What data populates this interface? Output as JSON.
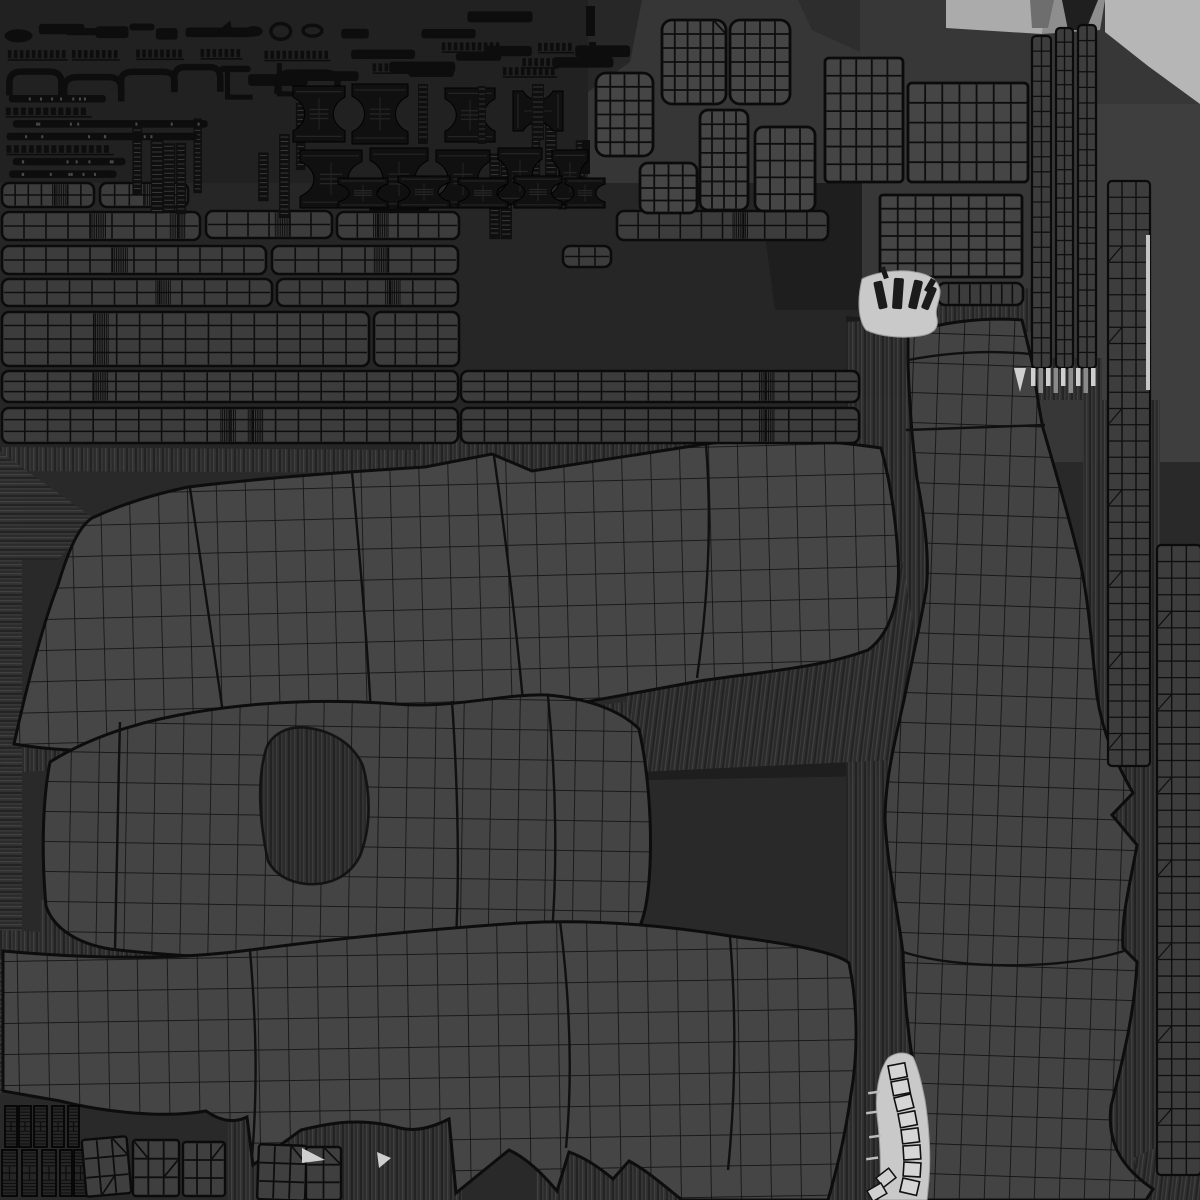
{
  "canvas": {
    "w": 1200,
    "h": 1200,
    "bg": "#292929"
  },
  "palette": {
    "base": "#292929",
    "dark_zone": "#212121",
    "mid_zone": "#363636",
    "right_zone": "#373737",
    "light_band": "#ababab",
    "light_corner": "#b6b6b6",
    "mesh_fill": "#454545",
    "strip_fill": "#3c3c3c",
    "wire": "#0d0d0d",
    "hardware": "#0f0f0f",
    "zipper_light": "#c9c9c9",
    "tooth_light": "#cfcfcf"
  },
  "patterns": {
    "grids": [
      {
        "id": "gA",
        "cw": 29,
        "ch": 31,
        "bg": "#464646",
        "line": "#141414",
        "lw": 1.7,
        "rot": -1.5
      },
      {
        "id": "gB",
        "cw": 28,
        "ch": 30,
        "bg": "#444444",
        "line": "#141414",
        "lw": 1.7,
        "rot": 1
      },
      {
        "id": "gC",
        "cw": 30,
        "ch": 31,
        "bg": "#454545",
        "line": "#131313",
        "lw": 1.7,
        "rot": -1
      },
      {
        "id": "gD",
        "cw": 25,
        "ch": 30,
        "bg": "#434343",
        "line": "#121212",
        "lw": 1.7,
        "rot": 2
      }
    ],
    "streaks": [
      {
        "id": "p-sv",
        "rot": 0
      },
      {
        "id": "p-sh",
        "rot": 90
      },
      {
        "id": "p-sd",
        "rot": 7
      }
    ],
    "streak_stripes": [
      [
        "#232323",
        2
      ],
      [
        "#3e3e3e",
        1
      ],
      [
        "#2b2b2b",
        2
      ],
      [
        "#464646",
        1
      ],
      [
        "#303030",
        3
      ]
    ]
  },
  "bg_patches": [
    {
      "pts": "0,0 588,0 588,183 0,183",
      "f": "#212121"
    },
    {
      "pts": "560,183 650,183 672,215 560,215",
      "f": "#212121"
    },
    {
      "pts": "588,0 860,0 860,215 672,215 650,183 588,183",
      "f": "#363636"
    },
    {
      "pts": "588,0 642,0 630,62 588,92",
      "f": "#272727"
    },
    {
      "pts": "798,0 860,0 860,52 812,30",
      "f": "#2d2d2d"
    },
    {
      "pts": "860,0 1200,0 1200,462 860,462",
      "f": "#373737"
    },
    {
      "pts": "946,0 1048,0 1042,34 946,28",
      "f": "#ababab"
    },
    {
      "pts": "1048,0 1105,0 1100,30 1042,34",
      "f": "#8e8e8e"
    },
    {
      "pts": "1105,0 1200,0 1200,104 1148,66 1105,32",
      "f": "#b6b6b6"
    },
    {
      "pts": "1062,0 1098,0 1086,30 1068,30",
      "f": "#1f1f1f"
    },
    {
      "pts": "1030,0 1054,0 1048,28 1032,28",
      "f": "#6e6e6e"
    },
    {
      "pts": "1096,104 1200,104 1200,462 1096,462",
      "f": "#3e3e3e"
    },
    {
      "pts": "0,183 862,183 862,452 0,452",
      "f": "#262626"
    },
    {
      "pts": "758,183 862,183 862,310 775,310",
      "f": "#1e1e1e"
    },
    {
      "pts": "846,316 912,322 938,460 846,560",
      "f": "#1a1a1a"
    },
    {
      "pts": "862,398 944,398 944,460 868,452",
      "f": "#2e2e2e"
    },
    {
      "pts": "640,690 940,642 940,775 648,780",
      "f": "#1e1e1e"
    },
    {
      "pts": "845,1040 942,1040 942,1200 845,1200",
      "f": "#1d1d1d"
    }
  ],
  "fringes": [
    {
      "pts": "0,447 420,450 420,473 0,471",
      "p": "p-sv"
    },
    {
      "pts": "420,432 893,440 893,463 420,473",
      "p": "p-sv"
    },
    {
      "pts": "0,452 95,519 58,560 0,560",
      "p": "p-sh"
    },
    {
      "pts": "0,742 520,716 640,700 640,731 520,748 0,773",
      "p": "p-sv"
    },
    {
      "pts": "40,900 640,928 640,963 40,963",
      "p": "p-sv"
    },
    {
      "pts": "0,468 22,468 22,1095 0,1095",
      "p": "p-sh"
    },
    {
      "pts": "846,322 944,316 944,1200 846,1200",
      "p": "p-sv"
    },
    {
      "pts": "1083,400 1160,400 1160,1195 1083,1195",
      "p": "p-sv"
    },
    {
      "pts": "600,560 900,548 936,758 640,772",
      "p": "p-sd"
    },
    {
      "pts": "228,1093 462,1120 462,1200 228,1200",
      "p": "p-sv"
    },
    {
      "pts": "536,1128 862,1120 862,1200 536,1200",
      "p": "p-sv"
    },
    {
      "pts": "878,458 942,452 942,562 892,562",
      "p": "p-sv"
    },
    {
      "pts": "1133,1158 1200,1128 1200,1200 1148,1200",
      "p": "p-sd"
    },
    {
      "pts": "898,296 1032,288 1032,332 898,340",
      "p": "p-sv"
    },
    {
      "pts": "1028,358 1102,358 1102,400 1028,400",
      "p": "p-sv"
    },
    {
      "pts": "0,930 242,941 242,966 0,958",
      "p": "p-sv"
    },
    {
      "pts": "240,660 470,648 470,700 240,712",
      "p": "p-sd"
    }
  ],
  "islands": [
    {
      "name": "uv-island-top-panel",
      "grid": "gA",
      "path": "M14,744 C28,680 45,618 58,585 C70,545 80,526 92,518 C120,505 155,494 188,487 C270,477 360,471 425,467 L492,454 L532,471 C580,464 642,454 705,444 C770,435 832,441 881,448 C890,480 896,520 898,557 C901,600 890,634 868,650 C820,668 760,672 700,681 C640,692 575,704 520,714 C420,728 310,740 215,748 C140,754 58,752 14,744 Z",
      "seams": [
        "M190,488 C203,575 216,662 228,747",
        "M494,456 C506,540 516,625 524,712",
        "M706,445 C712,520 708,600 697,678",
        "M352,472 C360,560 368,650 372,733"
      ]
    },
    {
      "name": "uv-island-collar-panel",
      "grid": "gB",
      "path": "M46,906 C41,850 43,798 50,762 C90,737 140,721 196,712 C262,701 332,699 396,704 C452,709 506,693 548,695 C592,699 622,712 639,729 C648,770 652,820 650,866 C648,906 642,928 634,933 C560,948 468,958 378,960 C288,962 178,957 110,949 C80,944 54,930 46,906 Z",
      "hole": "M268,861 C259,820 257,779 266,749 C272,733 289,725 309,728 C331,731 353,743 363,766 C371,795 371,828 360,856 C350,876 330,886 306,884 C287,882 274,873 268,861 Z",
      "seams": [
        "M452,701 C458,790 460,878 455,958",
        "M548,696 C556,780 558,868 551,945",
        "M120,722 C118,800 116,880 115,950"
      ]
    },
    {
      "name": "uv-island-bottom-panel",
      "grid": "gC",
      "path": "M3,951 C80,958 168,961 250,950 C340,938 432,929 520,923 C592,919 662,925 730,936 C790,944 836,952 849,963 C857,1002 859,1048 851,1094 C845,1138 836,1172 828,1200 L682,1200 C662,1184 646,1170 629,1161 L613,1179 C600,1168 586,1158 569,1152 L557,1191 C541,1172 526,1158 509,1150 L456,1193 L449,1119 C431,1128 415,1132 400,1128 C360,1117 330,1123 301,1130 L253,1165 L247,1117 C231,1125 216,1118 206,1111 C160,1119 100,1111 60,1101 L3,1091 Z",
      "seams": [
        "M250,951 C256,1020 258,1085 252,1158",
        "M560,921 C570,1000 573,1075 566,1148",
        "M730,937 C736,1010 736,1090 728,1170"
      ]
    },
    {
      "name": "uv-island-leg-panel",
      "grid": "gD",
      "path": "M908,334 C940,322 984,317 1022,320 L1033,366 C1037,396 1040,414 1043,428 C1055,470 1070,520 1081,566 C1090,610 1092,652 1097,696 C1103,736 1118,766 1133,793 L1112,815 L1137,845 C1130,885 1121,916 1123,948 L1137,962 C1135,1010 1123,1060 1111,1106 C1107,1140 1119,1166 1153,1189 L1146,1200 L921,1200 C928,1155 922,1110 913,1063 C906,1020 904,986 903,953 C897,906 887,863 885,820 C885,780 895,740 904,700 C912,660 920,626 926,591 C930,560 925,520 917,479 C912,440 909,400 908,360 Z",
      "seams": [
        "M906,430 L1045,425",
        "M903,952 C960,970 1062,970 1124,951",
        "M908,360 C950,352 990,350 1030,354"
      ]
    }
  ],
  "strips": [
    {
      "x": 2,
      "y": 183,
      "w": 92,
      "h": 24,
      "rows": 2,
      "cols": 7,
      "dense": [
        0.55
      ]
    },
    {
      "x": 100,
      "y": 183,
      "w": 88,
      "h": 24,
      "rows": 2,
      "cols": 6,
      "dense": [
        0.5
      ]
    },
    {
      "x": 2,
      "y": 212,
      "w": 198,
      "h": 28,
      "rows": 2,
      "cols": 9,
      "dense": [
        0.45,
        0.85
      ]
    },
    {
      "x": 206,
      "y": 211,
      "w": 126,
      "h": 27,
      "rows": 2,
      "cols": 6,
      "dense": [
        0.55
      ]
    },
    {
      "x": 337,
      "y": 212,
      "w": 122,
      "h": 27,
      "rows": 2,
      "cols": 6,
      "dense": [
        0.3
      ]
    },
    {
      "x": 617,
      "y": 211,
      "w": 211,
      "h": 29,
      "rows": 2,
      "cols": 10,
      "dense": [
        0.55
      ]
    },
    {
      "x": 2,
      "y": 246,
      "w": 264,
      "h": 28,
      "rows": 2,
      "cols": 12,
      "dense": [
        0.42
      ]
    },
    {
      "x": 272,
      "y": 246,
      "w": 186,
      "h": 28,
      "rows": 2,
      "cols": 8,
      "dense": [
        0.55
      ]
    },
    {
      "x": 563,
      "y": 246,
      "w": 48,
      "h": 21,
      "rows": 2,
      "cols": 3,
      "dense": []
    },
    {
      "x": 2,
      "y": 279,
      "w": 270,
      "h": 27,
      "rows": 2,
      "cols": 12,
      "dense": [
        0.57
      ]
    },
    {
      "x": 277,
      "y": 279,
      "w": 181,
      "h": 27,
      "rows": 2,
      "cols": 8,
      "dense": [
        0.6
      ]
    },
    {
      "x": 2,
      "y": 312,
      "w": 367,
      "h": 54,
      "rows": 4,
      "cols": 16,
      "dense": [
        0.25
      ]
    },
    {
      "x": 374,
      "y": 312,
      "w": 85,
      "h": 54,
      "rows": 4,
      "cols": 4,
      "dense": []
    },
    {
      "x": 2,
      "y": 371,
      "w": 456,
      "h": 31,
      "rows": 3,
      "cols": 20,
      "dense": [
        0.2
      ]
    },
    {
      "x": 461,
      "y": 371,
      "w": 398,
      "h": 31,
      "rows": 3,
      "cols": 17,
      "dense": [
        0.75
      ]
    },
    {
      "x": 2,
      "y": 408,
      "w": 456,
      "h": 35,
      "rows": 3,
      "cols": 20,
      "dense": [
        0.48,
        0.54
      ]
    },
    {
      "x": 461,
      "y": 408,
      "w": 398,
      "h": 35,
      "rows": 3,
      "cols": 17,
      "dense": [
        0.75
      ]
    },
    {
      "x": 938,
      "y": 283,
      "w": 85,
      "h": 22,
      "rows": 1,
      "cols": 8,
      "dense": []
    }
  ],
  "blocks": [
    {
      "x": 662,
      "y": 20,
      "w": 64,
      "h": 84,
      "cols": 5,
      "rows": 6,
      "rx": 10,
      "diag": [
        [
          4,
          0,
          1
        ]
      ]
    },
    {
      "x": 730,
      "y": 20,
      "w": 60,
      "h": 84,
      "cols": 4,
      "rows": 6,
      "rx": 10,
      "diag": []
    },
    {
      "x": 596,
      "y": 73,
      "w": 57,
      "h": 83,
      "cols": 4,
      "rows": 6,
      "rx": 10,
      "diag": []
    },
    {
      "x": 700,
      "y": 110,
      "w": 48,
      "h": 100,
      "cols": 4,
      "rows": 7,
      "rx": 8,
      "diag": []
    },
    {
      "x": 755,
      "y": 127,
      "w": 60,
      "h": 84,
      "cols": 4,
      "rows": 5,
      "rx": 8,
      "diag": []
    },
    {
      "x": 640,
      "y": 163,
      "w": 57,
      "h": 50,
      "cols": 4,
      "rows": 4,
      "rx": 8,
      "diag": []
    },
    {
      "x": 825,
      "y": 58,
      "w": 78,
      "h": 124,
      "cols": 5,
      "rows": 7,
      "rx": 4,
      "diag": []
    },
    {
      "x": 908,
      "y": 83,
      "w": 120,
      "h": 99,
      "cols": 7,
      "rows": 5,
      "rx": 4,
      "diag": []
    },
    {
      "x": 880,
      "y": 195,
      "w": 142,
      "h": 82,
      "cols": 8,
      "rows": 6,
      "rx": 3,
      "diag": []
    }
  ],
  "vstrips": [
    {
      "x": 1032,
      "y": 36,
      "w": 19,
      "h": 332,
      "cols": 2,
      "rows": 22,
      "marks": false
    },
    {
      "x": 1056,
      "y": 28,
      "w": 17,
      "h": 340,
      "cols": 2,
      "rows": 24,
      "marks": false
    },
    {
      "x": 1078,
      "y": 25,
      "w": 18,
      "h": 343,
      "cols": 2,
      "rows": 22,
      "marks": false
    },
    {
      "x": 1108,
      "y": 181,
      "w": 42,
      "h": 585,
      "cols": 3,
      "rows": 36,
      "marks": true
    },
    {
      "x": 1157,
      "y": 545,
      "w": 44,
      "h": 630,
      "cols": 3,
      "rows": 38,
      "marks": true
    }
  ],
  "spines": [
    {
      "x": 5,
      "y": 1106,
      "w": 12,
      "h": 41
    },
    {
      "x": 19,
      "y": 1106,
      "w": 12,
      "h": 41
    },
    {
      "x": 34,
      "y": 1106,
      "w": 13,
      "h": 41
    },
    {
      "x": 52,
      "y": 1106,
      "w": 12,
      "h": 41
    },
    {
      "x": 68,
      "y": 1106,
      "w": 11,
      "h": 41
    },
    {
      "x": 2,
      "y": 1150,
      "w": 15,
      "h": 46
    },
    {
      "x": 22,
      "y": 1150,
      "w": 15,
      "h": 46
    },
    {
      "x": 42,
      "y": 1150,
      "w": 14,
      "h": 46
    },
    {
      "x": 60,
      "y": 1150,
      "w": 12,
      "h": 46
    },
    {
      "x": 74,
      "y": 1150,
      "w": 13,
      "h": 46
    }
  ],
  "squares": [
    {
      "x": 84,
      "y": 1138,
      "w": 45,
      "h": 57,
      "cols": 3,
      "rows": 3,
      "rot": -5,
      "diag": [
        [
          2,
          0,
          1
        ],
        [
          1,
          2,
          -1
        ]
      ]
    },
    {
      "x": 133,
      "y": 1140,
      "w": 46,
      "h": 56,
      "cols": 3,
      "rows": 3,
      "rot": 0,
      "diag": [
        [
          0,
          0,
          1
        ],
        [
          2,
          1,
          -1
        ]
      ]
    },
    {
      "x": 183,
      "y": 1142,
      "w": 42,
      "h": 54,
      "cols": 3,
      "rows": 3,
      "rot": 0,
      "diag": [
        [
          2,
          0,
          -1
        ]
      ]
    },
    {
      "x": 258,
      "y": 1145,
      "w": 48,
      "h": 55,
      "cols": 3,
      "rows": 3,
      "rot": 2,
      "diag": [
        [
          2,
          0,
          1
        ]
      ]
    },
    {
      "x": 306,
      "y": 1147,
      "w": 35,
      "h": 53,
      "cols": 2,
      "rows": 3,
      "rot": 0,
      "diag": [
        [
          1,
          0,
          1
        ]
      ]
    }
  ],
  "spools": [
    [
      293,
      86,
      52,
      56,
      0
    ],
    [
      352,
      84,
      56,
      60,
      0
    ],
    [
      445,
      88,
      50,
      54,
      0
    ],
    [
      518,
      86,
      40,
      50,
      90
    ],
    [
      300,
      150,
      62,
      58,
      0
    ],
    [
      370,
      148,
      58,
      62,
      0
    ],
    [
      436,
      150,
      54,
      58,
      0
    ],
    [
      498,
      148,
      44,
      56,
      0
    ],
    [
      552,
      150,
      36,
      54,
      0
    ],
    [
      338,
      178,
      50,
      30,
      0
    ],
    [
      398,
      176,
      52,
      32,
      0
    ],
    [
      458,
      178,
      50,
      30,
      0
    ],
    [
      514,
      176,
      48,
      32,
      0
    ],
    [
      565,
      178,
      40,
      30,
      0
    ]
  ],
  "spool_bars": [
    [
      418,
      84,
      10,
      60
    ],
    [
      478,
      86,
      8,
      58
    ],
    [
      532,
      84,
      12,
      56
    ]
  ],
  "vbars": [
    [
      586,
      6,
      9,
      30
    ],
    [
      589,
      42,
      7,
      20
    ],
    [
      582,
      140,
      8,
      34
    ]
  ],
  "dots": [
    [
      466,
      121,
      5
    ],
    [
      522,
      117,
      4
    ],
    [
      341,
      204,
      4
    ],
    [
      299,
      131,
      3
    ]
  ],
  "scatter": {
    "seed": 7,
    "bands": [
      {
        "x": 6,
        "y": 20,
        "w": 320,
        "h": 24,
        "n": 11,
        "t": [
          "oval",
          "bar",
          "bar",
          "ring",
          "wedge"
        ]
      },
      {
        "x": 334,
        "y": 8,
        "w": 250,
        "h": 74,
        "n": 15,
        "t": [
          "bar",
          "bar",
          "dashbar"
        ]
      },
      {
        "x": 6,
        "y": 47,
        "w": 322,
        "h": 15,
        "n": 5,
        "t": [
          "dashbar"
        ]
      },
      {
        "x": 6,
        "y": 64,
        "w": 320,
        "h": 30,
        "n": 6,
        "t": [
          "bridge",
          "bridge",
          "hook"
        ]
      },
      {
        "x": 128,
        "y": 100,
        "w": 78,
        "h": 78,
        "n": 5,
        "t": [
          "vstrip"
        ]
      },
      {
        "x": 212,
        "y": 58,
        "w": 115,
        "h": 34,
        "n": 4,
        "t": [
          "hook",
          "bar"
        ]
      },
      {
        "x": 256,
        "y": 96,
        "w": 58,
        "h": 84,
        "n": 3,
        "t": [
          "vstrip"
        ]
      },
      {
        "x": 482,
        "y": 85,
        "w": 102,
        "h": 96,
        "n": 7,
        "t": [
          "vstrip",
          "vdash"
        ]
      }
    ],
    "stacked": {
      "x": 4,
      "y": 95,
      "w": 245,
      "h": 88,
      "rows": 7,
      "t": [
        "longbar",
        "dashlong",
        "longbar"
      ]
    }
  },
  "zipper_top": {
    "path": "M862,279 C875,272 900,269 915,272 C928,274 938,279 940,290 C941,300 934,308 937,318 C939,328 934,334 920,336 C900,339 878,336 866,330 C858,320 857,300 862,279 Z",
    "marks": [
      [
        876,
        281,
        9,
        28,
        -12
      ],
      [
        893,
        278,
        10,
        31,
        4
      ],
      [
        911,
        280,
        9,
        29,
        13
      ],
      [
        925,
        286,
        8,
        24,
        22
      ]
    ],
    "hooks": [
      [
        880,
        268,
        5,
        12,
        -20
      ],
      [
        931,
        278,
        6,
        14,
        30
      ]
    ]
  },
  "zipper_bottom": {
    "path": "M888,1058 C896,1052 906,1051 913,1057 C918,1068 921,1080 925,1100 C929,1125 931,1155 929,1180 L927,1200 L879,1200 C882,1170 880,1140 877,1115 C875,1095 878,1072 888,1058 Z",
    "ladder": [
      [
        888,
        1066
      ],
      [
        891,
        1082
      ],
      [
        894,
        1098
      ],
      [
        898,
        1114
      ],
      [
        901,
        1130
      ],
      [
        903,
        1146
      ],
      [
        904,
        1162
      ],
      [
        903,
        1178
      ],
      [
        900,
        1191
      ]
    ],
    "stray": [
      [
        876,
        1178,
        -38
      ],
      [
        867,
        1191,
        -30
      ]
    ],
    "ticks": [
      [
        868,
        1092
      ],
      [
        866,
        1112
      ],
      [
        869,
        1136
      ],
      [
        866,
        1158
      ]
    ]
  },
  "teeth": {
    "x0": 1031,
    "y": 368,
    "n": 9,
    "step": 7.5,
    "w": 4.5,
    "hbase": 18,
    "hvar": 14
  },
  "light_sliver": {
    "x": 1146,
    "y": 235,
    "w": 4,
    "h": 155
  },
  "light_wedges": [
    "302,1148 325,1160 302,1163",
    "377,1152 391,1158 379,1168",
    "1014,368 1026,368 1020,392"
  ]
}
